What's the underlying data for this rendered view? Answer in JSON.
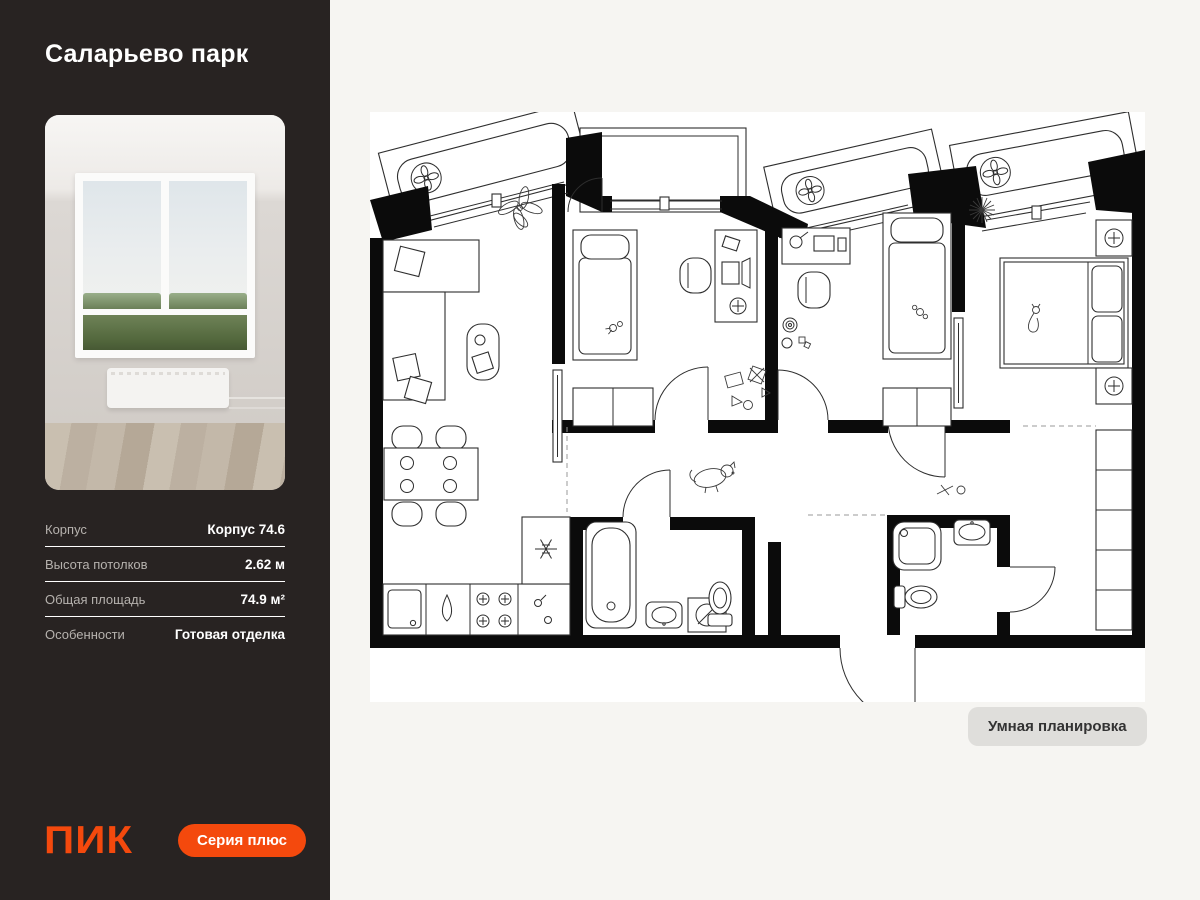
{
  "sidebar": {
    "title": "Саларьево парк",
    "details": [
      {
        "label": "Корпус",
        "value": "Корпус 74.6"
      },
      {
        "label": "Высота потолков",
        "value": "2.62 м"
      },
      {
        "label": "Общая площадь",
        "value": "74.9 м²"
      },
      {
        "label": "Особенности",
        "value": "Готовая отделка"
      }
    ],
    "logo": "ПИК",
    "badge": "Серия плюс"
  },
  "main": {
    "smart_layout_button": "Умная планировка"
  },
  "plan": {
    "type": "apartment-floor-plan",
    "icons": [
      "fan-icon",
      "snowflake-icon",
      "ceiling-lamp-icon"
    ]
  },
  "colors": {
    "accent_orange": "#F4490D",
    "sidebar_bg": "#282322",
    "main_bg": "#F6F5F2",
    "plan_bg": "#FFFFFF",
    "smart_button_bg": "#DFDEDB",
    "detail_label": "#B6B2AE",
    "detail_value": "#FFFFFF"
  }
}
